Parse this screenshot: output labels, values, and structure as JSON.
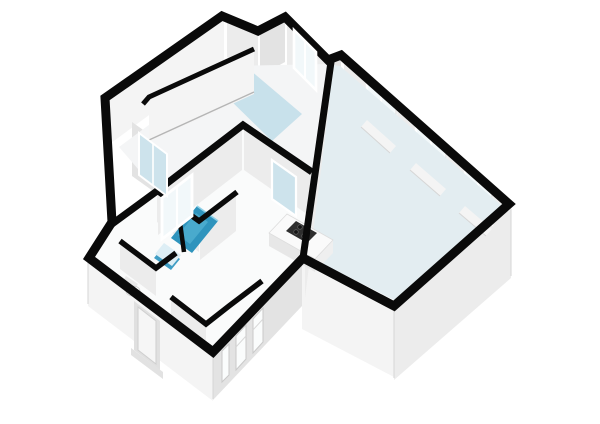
{
  "canvas": {
    "width": 600,
    "height": 424,
    "background": "#ffffff"
  },
  "palette": {
    "bg": "#ffffff",
    "wallTop": "#0a0a0a",
    "faceLight": "#f4f4f4",
    "faceMid": "#ececec",
    "faceDark": "#e3e3e3",
    "faceShadow": "#dcdcdc",
    "floorWhite": "#fafbfb",
    "floorBedroom": "#f4f5f6",
    "floorBlue": "#c8e1eb",
    "floorLiving": "#e3edf1",
    "glass": "#cde3ec",
    "glassPale": "#f2f8fa",
    "tubBlue": "#2f94bd",
    "tubBlueLight": "#49aacd",
    "sinkBlue": "#3f9dc4",
    "sinkTop": "#ddeef5",
    "frameWhite": "#ffffff",
    "stoveDark": "#2e2e2e",
    "burner": "#161616",
    "edgeLine": "#d6d6d6",
    "toiletWhite": "#fdfdfd"
  },
  "scene": {
    "type": "isometric-3d-floor-plan",
    "rooms": [
      {
        "id": "room-upper-left",
        "floor": "white-with-blue-nook",
        "features": [
          "interior-partition-wall",
          "window-nook"
        ]
      },
      {
        "id": "room-right-large",
        "floor": "pale-blue",
        "features": [
          "three-tall-window-groups",
          "kitchen-counter",
          "glazed-interior-door"
        ]
      },
      {
        "id": "rooms-lower-left-cluster",
        "floor": "white",
        "features": [
          "bathtub",
          "washbasin",
          "toilet",
          "interior-window",
          "diagonal-closet-wall",
          "entry-door",
          "louvre-slit-vents"
        ]
      }
    ],
    "fixtures": [
      {
        "id": "bathtub",
        "color_key": "tubBlue"
      },
      {
        "id": "washbasin",
        "color_key": "sinkBlue"
      },
      {
        "id": "toilet",
        "color_key": "toiletWhite"
      },
      {
        "id": "kitchen-counter",
        "color_key": "floorWhite"
      },
      {
        "id": "cooktop",
        "burners": 4,
        "color_key": "stoveDark"
      },
      {
        "id": "glazed-door",
        "color_key": "glass"
      },
      {
        "id": "entry-door",
        "color_key": "faceLight"
      }
    ],
    "window_groups_right_wall": 3,
    "slit_vents_front_wall": 3
  }
}
